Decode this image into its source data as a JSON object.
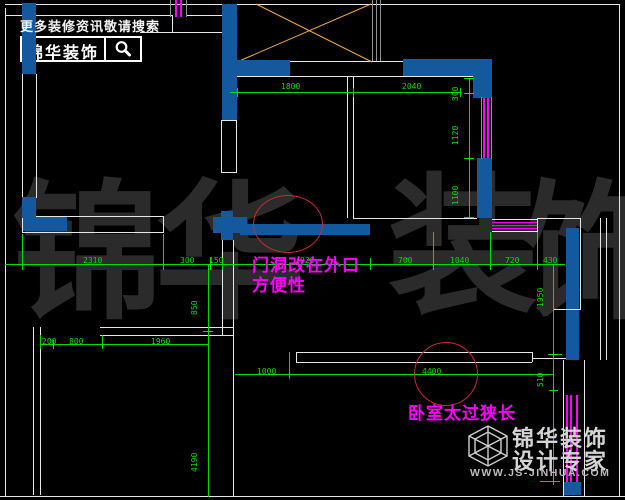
{
  "header": {
    "promo": "更多装修资讯敬请搜索",
    "brand": "锦华装饰",
    "search_icon": "magnifier-icon"
  },
  "watermark": {
    "c0": "锦",
    "c1": "华",
    "c2": "装",
    "c3": "饰"
  },
  "footer": {
    "brand": "锦华装饰",
    "tagline": "设计专家",
    "site": "WWW.JS-JINHUA.COM",
    "logo_icon": "cube-logo-icon"
  },
  "notes": {
    "door": {
      "line1": "门洞改在外口",
      "line2": "方便性"
    },
    "bedroom": "卧室太过狭长"
  },
  "dims": {
    "top": {
      "d0": "1800",
      "d1": "2040"
    },
    "right_room": {
      "d0": "300",
      "d1": "1120",
      "d2": "1100"
    },
    "middle": {
      "d0": "2310",
      "d1": "300",
      "d2": "150",
      "d3": "920",
      "d4": "700",
      "d5": "1040",
      "d6": "720",
      "d7": "430"
    },
    "left_col": {
      "d0": "850",
      "d1": "4190"
    },
    "right_col": {
      "d0": "1950",
      "d1": "510"
    },
    "bottom_left": {
      "d0": "200",
      "d1": "800",
      "d2": "1960"
    },
    "bottom_mid": {
      "d0": "1000",
      "d1": "4400"
    }
  },
  "colors": {
    "wall_blue": "#14589d",
    "dim_green": "#00df00",
    "window_magenta": "#ff00ff",
    "cross_orange": "#f0a843",
    "circle_red": "#cc2a2a",
    "note_magenta": "#ff00ff",
    "line_white": "#e6e6e6",
    "background": "#000000"
  }
}
